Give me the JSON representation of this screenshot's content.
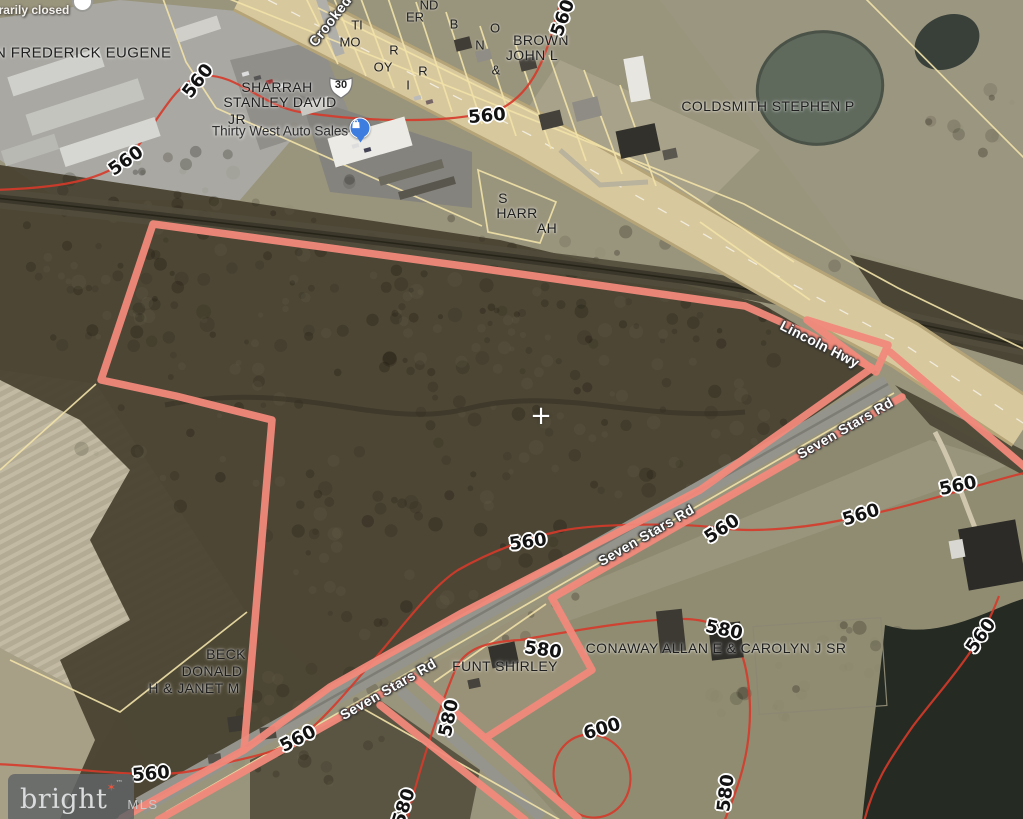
{
  "map": {
    "attribution": {
      "brand": "bright",
      "tm": "™",
      "suffix": "MLS"
    },
    "center_marker": "+",
    "route_shield": {
      "number": "30",
      "x": 341,
      "y": 87
    },
    "poi": {
      "name": "Thirty West Auto Sales",
      "x": 280,
      "y": 131,
      "status": "temporarily closed",
      "status_x": 16,
      "status_y": 10,
      "icon": "shopping-bag"
    },
    "road_labels": [
      {
        "text": "Lincoln Hwy",
        "x": 820,
        "y": 344,
        "rot": 27
      },
      {
        "text": "Seven Stars Rd",
        "x": 845,
        "y": 428,
        "rot": -30
      },
      {
        "text": "Seven Stars Rd",
        "x": 646,
        "y": 535,
        "rot": -30
      },
      {
        "text": "Seven Stars Rd",
        "x": 388,
        "y": 689,
        "rot": -30
      },
      {
        "text": "Crooked",
        "x": 330,
        "y": 21,
        "rot": -52
      }
    ],
    "owner_labels": [
      {
        "text": "AN FREDERICK EUGENE",
        "x": 78,
        "y": 53,
        "size": 15
      },
      {
        "text": "SHARRAH",
        "x": 277,
        "y": 87
      },
      {
        "text": "STANLEY DAVID",
        "x": 280,
        "y": 102
      },
      {
        "text": "JR",
        "x": 237,
        "y": 119
      },
      {
        "text": "BROWN",
        "x": 541,
        "y": 40
      },
      {
        "text": "JOHN L",
        "x": 532,
        "y": 55
      },
      {
        "text": "COLDSMITH STEPHEN P",
        "x": 768,
        "y": 106
      },
      {
        "text": "S",
        "x": 503,
        "y": 198
      },
      {
        "text": "HARR",
        "x": 517,
        "y": 213
      },
      {
        "text": "AH",
        "x": 547,
        "y": 228
      },
      {
        "text": "BECK",
        "x": 226,
        "y": 654
      },
      {
        "text": "DONALD",
        "x": 212,
        "y": 671
      },
      {
        "text": "H & JANET M",
        "x": 194,
        "y": 688
      },
      {
        "text": "FUNT SHIRLEY",
        "x": 505,
        "y": 666
      },
      {
        "text": "CONAWAY ALLAN E & CAROLYN J SR",
        "x": 716,
        "y": 648
      }
    ],
    "parcel_letter_fragments": [
      {
        "text": "TI",
        "x": 357,
        "y": 25
      },
      {
        "text": "MO",
        "x": 350,
        "y": 42
      },
      {
        "text": "R",
        "x": 394,
        "y": 50
      },
      {
        "text": "OY",
        "x": 383,
        "y": 67
      },
      {
        "text": "I",
        "x": 408,
        "y": 85
      },
      {
        "text": "ER",
        "x": 415,
        "y": 17
      },
      {
        "text": "ND",
        "x": 429,
        "y": 5
      },
      {
        "text": "R",
        "x": 423,
        "y": 71
      },
      {
        "text": "B",
        "x": 454,
        "y": 24
      },
      {
        "text": "O",
        "x": 495,
        "y": 28
      },
      {
        "text": "N",
        "x": 480,
        "y": 45
      },
      {
        "text": "&",
        "x": 496,
        "y": 70
      }
    ],
    "contour_labels": [
      {
        "text": "560",
        "x": 563,
        "y": 18,
        "rot": -70
      },
      {
        "text": "560",
        "x": 487,
        "y": 116,
        "rot": -5
      },
      {
        "text": "560",
        "x": 198,
        "y": 81,
        "rot": -52
      },
      {
        "text": "560",
        "x": 126,
        "y": 161,
        "rot": -35
      },
      {
        "text": "560",
        "x": 958,
        "y": 486,
        "rot": -12
      },
      {
        "text": "560",
        "x": 861,
        "y": 515,
        "rot": -17
      },
      {
        "text": "560",
        "x": 722,
        "y": 529,
        "rot": -33
      },
      {
        "text": "560",
        "x": 528,
        "y": 542,
        "rot": -8
      },
      {
        "text": "560",
        "x": 298,
        "y": 739,
        "rot": -27
      },
      {
        "text": "560",
        "x": 151,
        "y": 774,
        "rot": -5
      },
      {
        "text": "560",
        "x": 981,
        "y": 636,
        "rot": -55
      },
      {
        "text": "580",
        "x": 543,
        "y": 650,
        "rot": 8
      },
      {
        "text": "580",
        "x": 724,
        "y": 630,
        "rot": 12
      },
      {
        "text": "580",
        "x": 449,
        "y": 718,
        "rot": -78
      },
      {
        "text": "580",
        "x": 404,
        "y": 807,
        "rot": -72
      },
      {
        "text": "580",
        "x": 726,
        "y": 793,
        "rot": -83
      },
      {
        "text": "600",
        "x": 602,
        "y": 729,
        "rot": -16
      }
    ],
    "colors": {
      "property_boundary": "#F1897B",
      "contour": "#D63A2A",
      "parcel_line": "#F2E2A8",
      "highway": "#D7C798",
      "marker_blue": "#3E7DE0",
      "logo_star": "#E8543F"
    }
  }
}
